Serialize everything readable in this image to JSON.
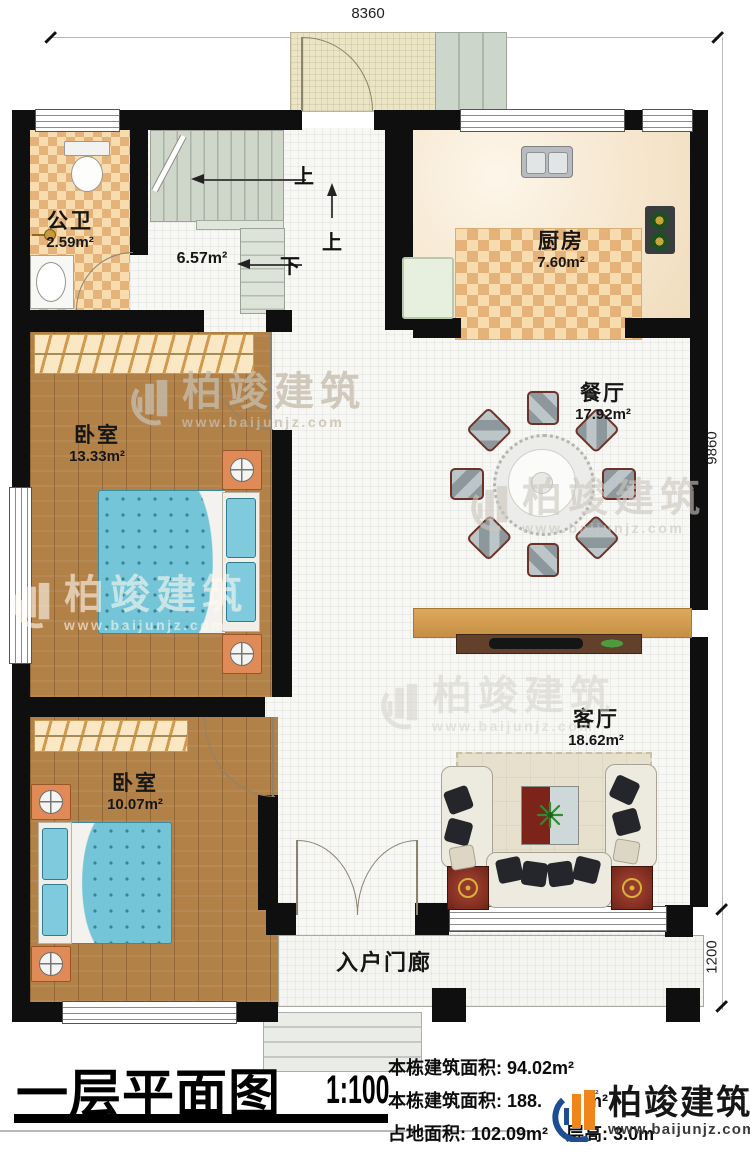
{
  "plan": {
    "dim_top": "8360",
    "dim_right_upper": "9860",
    "dim_right_lower": "1200",
    "rooms": {
      "bathroom": {
        "name": "公卫",
        "area": "2.59m²"
      },
      "stair_hall": {
        "area": "6.57m²"
      },
      "kitchen": {
        "name": "厨房",
        "area": "7.60m²"
      },
      "dining": {
        "name": "餐厅",
        "area": "17.92m²"
      },
      "bedroom1": {
        "name": "卧室",
        "area": "13.33m²"
      },
      "bedroom2": {
        "name": "卧室",
        "area": "10.07m²"
      },
      "living": {
        "name": "客厅",
        "area": "18.62m²"
      },
      "porch": {
        "name": "入户门廊"
      }
    },
    "stair_labels": {
      "up_upper": "上",
      "up_lower": "上",
      "down": "下"
    }
  },
  "title_block": {
    "title": "一层平面图",
    "scale": "1:100",
    "stats": [
      {
        "label": "本栋建筑面积: ",
        "value": "94.02m²"
      },
      {
        "label": "本栋建筑面积: ",
        "value": "188.",
        "suffix": "m²"
      },
      {
        "label": "占地面积: ",
        "value": "102.09m²"
      },
      {
        "label": "层高: ",
        "value": "3.0m"
      }
    ]
  },
  "branding": {
    "name": "柏竣建筑",
    "url": "www.baijunjz.com"
  },
  "watermark": {
    "name": "柏竣建筑",
    "url": "www.baijunjz.com"
  },
  "colors": {
    "wall": "#0f0f0f",
    "brand_orange": "#f08519",
    "brand_blue": "#1d4e91",
    "bed_blue": "#74c5d8",
    "wood": "#b28148"
  }
}
